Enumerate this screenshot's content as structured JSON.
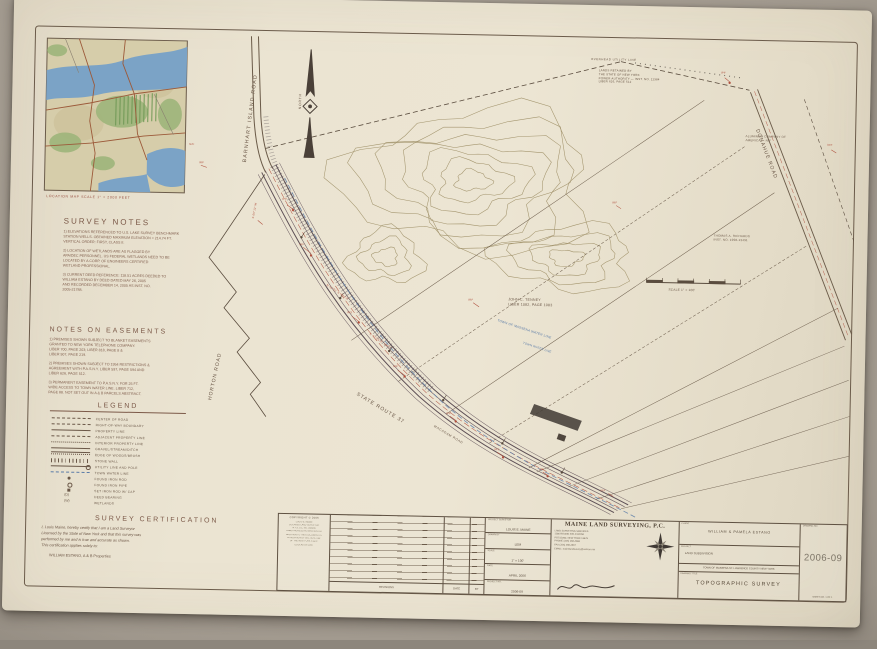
{
  "photo": {
    "background": "#9c948a"
  },
  "sheet": {
    "paper": "#e9e1cf",
    "ink": "#5f5142",
    "heading_ink": "#7c5a49",
    "red_ink": "#b0513f",
    "blue_ink": "#5b7ca8",
    "contour_ink": "#97875c"
  },
  "location_map": {
    "caption": "LOCATION MAP   SCALE 1\" = 2000 FEET"
  },
  "survey_notes": {
    "title": "SURVEY NOTES",
    "items": [
      "1) ELEVATIONS REFERENCED TO U.S. LAKE SURVEY BENCHMARK\nSTATION WELLS. OBTAINED MAXIMUM ELEVATION = 214.74 FT.\nVERTICAL ORDER: FIRST, CLASS II.",
      "2) LOCATION OF WETLANDS ARE AS FLAGGED BY\nAPA/DEC PERSONNEL.  US FEDERAL WETLANDS NEED TO BE\nLOCATED BY A CORP. OF ENGINEERS CERTIFIED\nWETLAND PROFESSIONAL.",
      "3) CURRENT DEED REFERENCE: 118.51 ACRES DEEDED TO\nWILLIAM ESTANO BY DEED DATED MAY 26, 2005\nAND RECORDED DECEMBER 14, 2005 AS INST. NO.\n2005-21788."
    ]
  },
  "easements": {
    "title": "NOTES ON EASEMENTS",
    "items": [
      "1) PREMISES SHOWN SUBJECT TO BLANKET EASEMENTS\nGRANTED TO NEW YORK TELEPHONE COMPANY.\nLIBER 700, PAGE 203; LIBER 818, PAGE 8 &\nLIBER 907, PAGE 219.",
      "2) PREMISES SHOWN SUBJECT TO 1954 RESTRICTIONS &\nAGREEMENT WITH P.A.S.N.Y.  LIBER 597, PAGE 594 AND\nLIBER 626, PAGE 512.",
      "3) PERMANENT EASEMENT TO P.A.S.N.Y. FOR 25 FT.\nWIDE ACCESS TO TOWN WATER LINE. LIBER 712,\nPAGE 88. NOT SET OUT IN A & B PARCELS ABSTRACT."
    ]
  },
  "legend": {
    "title": "LEGEND",
    "items": [
      {
        "sym": "dashdot",
        "mark": "",
        "label": "CENTER OF ROAD"
      },
      {
        "sym": "dash",
        "mark": "",
        "label": "RIGHT-OF-WAY BOUNDARY"
      },
      {
        "sym": "solid",
        "mark": "",
        "label": "PROPERTY LINE"
      },
      {
        "sym": "longdash",
        "mark": "",
        "label": "ADJACENT PROPERTY LINE"
      },
      {
        "sym": "shortdash",
        "mark": "",
        "label": "INTERIOR PROPERTY LINE"
      },
      {
        "sym": "double",
        "mark": "",
        "label": "GRAVEL/STREAM/DITCH"
      },
      {
        "sym": "scallop",
        "mark": "",
        "label": "EDGE OF WOODS/BRUSH"
      },
      {
        "sym": "hatch",
        "mark": "",
        "label": "STONE WALL"
      },
      {
        "sym": "utility",
        "mark": "",
        "label": "UTILITY LINE AND POLE"
      },
      {
        "sym": "water",
        "mark": "",
        "label": "TOWN WATER LINE"
      },
      {
        "sym": "rodfilled",
        "mark": "",
        "label": "FOUND IRON ROD"
      },
      {
        "sym": "pipeopen",
        "mark": "",
        "label": "FOUND IRON PIPE"
      },
      {
        "sym": "capsquare",
        "mark": "",
        "label": "SET IRON ROD W/ CAP"
      },
      {
        "sym": "deed",
        "mark": "(D)",
        "label": "DEED BEARING"
      },
      {
        "sym": "wet",
        "mark": "(W)",
        "label": "WETLANDS"
      }
    ]
  },
  "certification": {
    "title": "SURVEY CERTIFICATION",
    "body": "I, Louis Maine, hereby certify that I am a Land Surveyor\nLicensed by the State of New York and that this survey was\nperformed by me and is true and accurate as shown.\nThis certification applies solely to:",
    "applies_to": "WILLIAM ESTANO, A & B Properties"
  },
  "map": {
    "labels": [
      {
        "t": "BARNHART ISLAND ROAD",
        "x": 239,
        "y": 166,
        "rot": -84,
        "s": 5.2,
        "ls": 1.2
      },
      {
        "t": "HORTON ROAD",
        "x": 209,
        "y": 404,
        "rot": -79,
        "s": 5,
        "ls": 1
      },
      {
        "t": "STATE ROUTE 37",
        "x": 360,
        "y": 393,
        "rot": 30,
        "s": 5,
        "ls": 1
      },
      {
        "t": "MACADAM ROAD",
        "x": 437,
        "y": 425,
        "rot": 30,
        "s": 3.2,
        "ls": 0.6
      },
      {
        "t": "DONAHUE ROAD",
        "x": 756,
        "y": 122,
        "rot": 68,
        "s": 5,
        "ls": 1
      },
      {
        "t": "NORTH",
        "x": 294,
        "y": 112,
        "rot": -90,
        "s": 3.4,
        "ls": 0.8
      },
      {
        "t": "JOHN C. TENNEY\nLIBER 1082, PAGE 1083",
        "x": 508,
        "y": 296,
        "s": 3.6,
        "lh": 1.4
      },
      {
        "t": "ALUMINUM COMPANY OF\nAMERICA — N/F",
        "x": 742,
        "y": 128,
        "s": 3,
        "lh": 1.35
      },
      {
        "t": "THOMAS A. RICHARDS\nINST. NO. 1998-13491",
        "x": 712,
        "y": 228,
        "s": 3,
        "lh": 1.35
      },
      {
        "t": "LANDS RETAINED BY\nTHE STATE OF NEW YORK\nPOWER AUTHORITY — INST. NO. 11384\nLIBER 626, PAGE 512",
        "x": 594,
        "y": 66,
        "s": 2.9,
        "lh": 1.3
      },
      {
        "t": "OVERHEAD UTILITY LINE",
        "x": 586,
        "y": 55,
        "s": 2.9,
        "ls": 0.5
      },
      {
        "t": "TOWN OF MASSENA WATER LINE",
        "x": 498,
        "y": 318,
        "rot": 17,
        "s": 3.2,
        "c": "#5b7ca8"
      },
      {
        "t": "TOWN WATER LINE",
        "x": 524,
        "y": 340,
        "rot": 17,
        "s": 2.9,
        "c": "#5b7ca8"
      },
      {
        "t": "SCALE 1\" = 100'",
        "x": 668,
        "y": 284,
        "s": 3.2
      },
      {
        "t": "IRF",
        "x": 298,
        "y": 246,
        "s": 2.8,
        "c": "#b0513f"
      },
      {
        "t": "IPF",
        "x": 280,
        "y": 201,
        "s": 2.8,
        "c": "#b0513f"
      },
      {
        "t": "N/F",
        "x": 186,
        "y": 148,
        "s": 2.8,
        "c": "#b0513f"
      },
      {
        "t": "IRS",
        "x": 347,
        "y": 313,
        "s": 2.8,
        "c": "#b0513f"
      },
      {
        "t": "IRF",
        "x": 394,
        "y": 366,
        "s": 2.8,
        "c": "#b0513f"
      },
      {
        "t": "IPF",
        "x": 448,
        "y": 412,
        "s": 2.8,
        "c": "#b0513f"
      },
      {
        "t": "IRS",
        "x": 497,
        "y": 447,
        "s": 2.8,
        "c": "#b0513f"
      },
      {
        "t": "IRF",
        "x": 542,
        "y": 466,
        "s": 2.8,
        "c": "#b0513f"
      },
      {
        "t": "N 42°51' E  214.6'",
        "x": 327,
        "y": 286,
        "rot": 33,
        "s": 2.8,
        "c": "#b0513f"
      },
      {
        "t": "N 47°25' E  190.2'",
        "x": 371,
        "y": 334,
        "rot": 34,
        "s": 2.8,
        "c": "#b0513f"
      },
      {
        "t": "IRF",
        "x": 468,
        "y": 298,
        "s": 2.8,
        "c": "#b0513f"
      },
      {
        "t": "IPF",
        "x": 716,
        "y": 66,
        "s": 2.8,
        "c": "#b0513f"
      },
      {
        "t": "IRF",
        "x": 824,
        "y": 136,
        "s": 2.8,
        "c": "#b0513f"
      },
      {
        "t": "IRF",
        "x": 604,
        "y": 486,
        "s": 2.8,
        "c": "#b0513f"
      },
      {
        "t": "S 05°12' W",
        "x": 250,
        "y": 222,
        "rot": -80,
        "s": 2.8,
        "c": "#b0513f"
      },
      {
        "t": "IRF",
        "x": 196,
        "y": 166,
        "s": 2.8,
        "c": "#b0513f"
      },
      {
        "t": "IRF",
        "x": 610,
        "y": 198,
        "s": 2.8,
        "c": "#b0513f"
      }
    ]
  },
  "title_block": {
    "copyright": "COPYRIGHT © 2006",
    "stamp_lines": [
      "LOUIS E. MAINE",
      "LICENSED LAND SURVEYOR",
      "N.Y.S. LIC. NO. 049096",
      "UNAUTHORIZED ALTERATION OR",
      "ADDITION TO THIS DOCUMENT IS",
      "A VIOLATION OF SECTION 7209",
      "OF THE NEW YORK STATE",
      "EDUCATION LAW"
    ],
    "revisions": {
      "rows_label": "REVISIONS",
      "date_label": "DATE",
      "by_label": "BY"
    },
    "info_rows": [
      {
        "label": "PROJECT SURVEYOR",
        "value": "LOUIS E. MAINE"
      },
      {
        "label": "DRAWN BY",
        "value": "LEM"
      },
      {
        "label": "SCALE",
        "value": "1\" = 100'"
      },
      {
        "label": "DATE",
        "value": "APRIL 2006"
      },
      {
        "label": "PROJECT NO.",
        "value": "2006-09"
      }
    ],
    "company": {
      "name": "MAINE LAND SURVEYING, P.C.",
      "lines": [
        "LAND SURVEYING SERVICES",
        "1186 ROUND FIELD ROAD",
        "POTSDAM, NEW YORK 13676",
        "PHONE (315) 268-4666",
        "FAX (315) 268-4667",
        "EMAIL: mainelandsurvey@verizon.net"
      ]
    },
    "client": {
      "label": "CLIENT",
      "name": "WILLIAM  &  PAMELA  ESTANO",
      "project_label": "PROJECT",
      "project": "LAND SUBDIVISION",
      "location": "TOWN OF MASSENA      ST. LAWRENCE COUNTY      NEW YORK",
      "title_label": "DRAWING TITLE",
      "title": "TOPOGRAPHIC SURVEY"
    },
    "number": {
      "label": "DRAWING NO.",
      "value": "2006-09",
      "sheet": "SHEET NO. 1 OF 1"
    }
  }
}
